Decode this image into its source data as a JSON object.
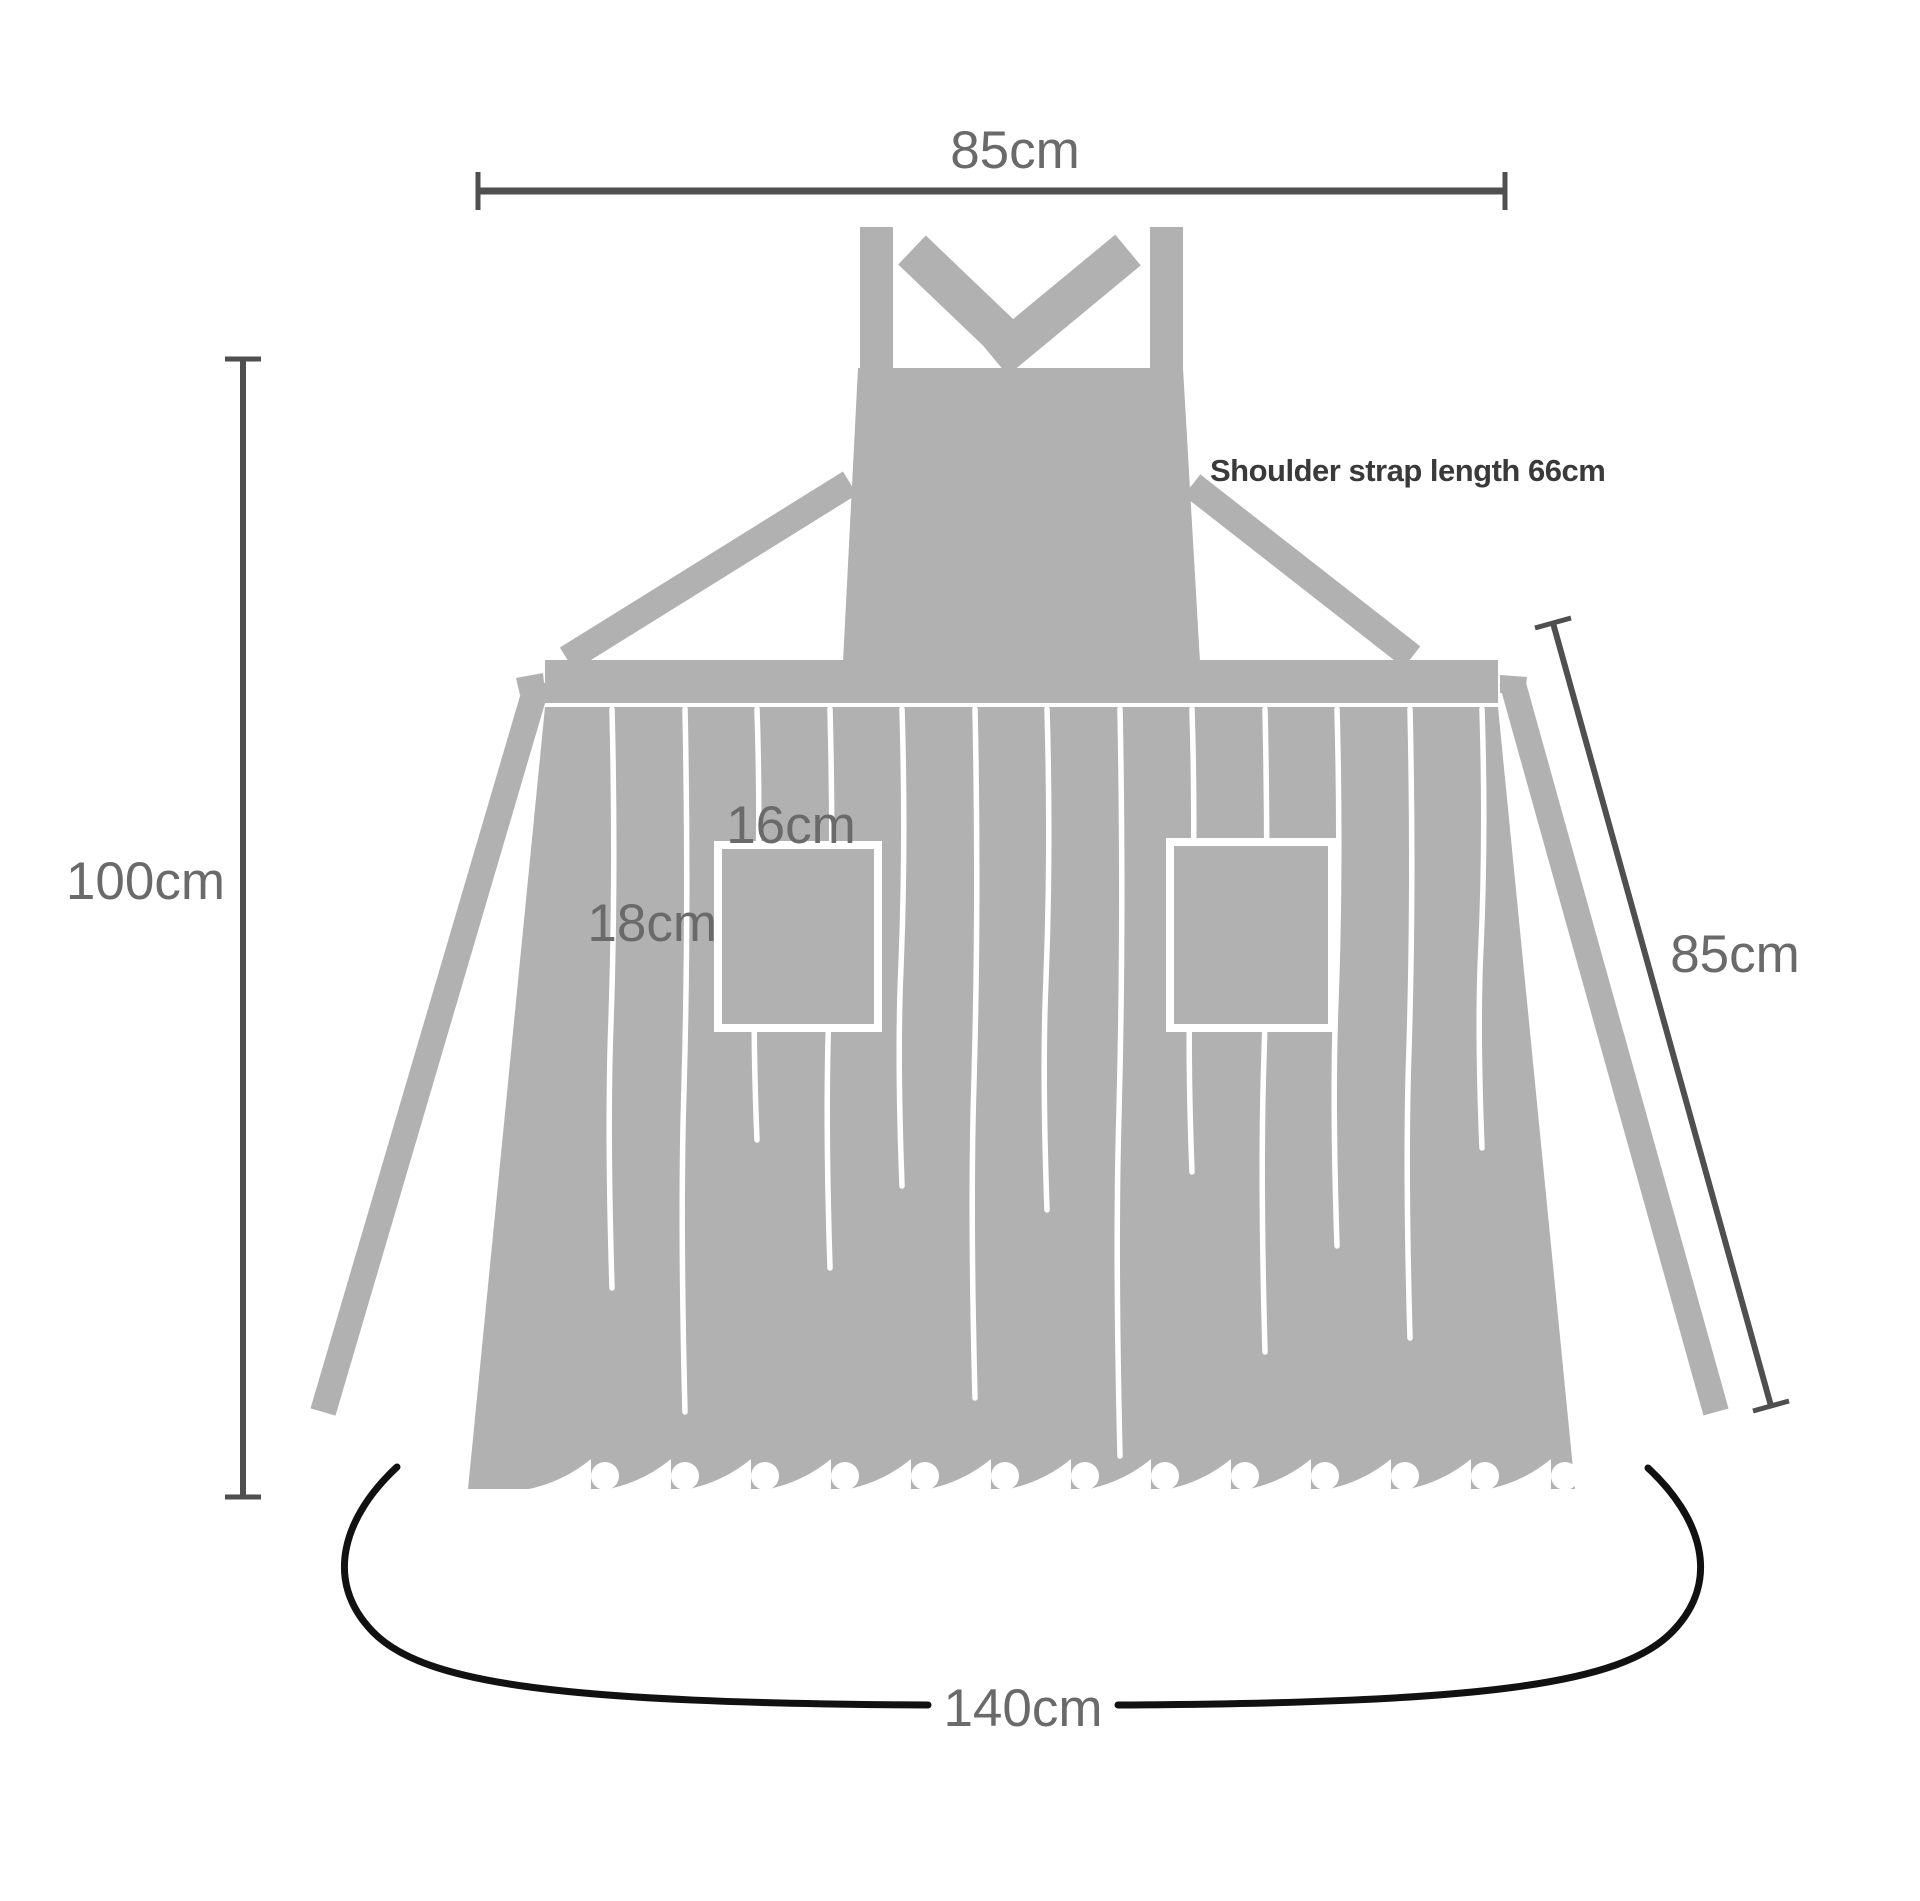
{
  "title": "Apron dimension diagram",
  "diagram": {
    "labels": {
      "top_width": "85cm",
      "height": "100cm",
      "shoulder_strap": "Shoulder strap length 66cm",
      "pocket_width": "16cm",
      "pocket_height": "18cm",
      "side_length": "85cm",
      "bottom_width": "140cm"
    },
    "colors": {
      "apron_gray": "#b1b1b1",
      "stripe_white": "#ffffff",
      "dimension_line": "#4f4f4f",
      "label_text": "#6a6a6a",
      "bold_label_text": "#3a3a3a",
      "bottom_curve": "#111111",
      "background": "#ffffff"
    }
  }
}
